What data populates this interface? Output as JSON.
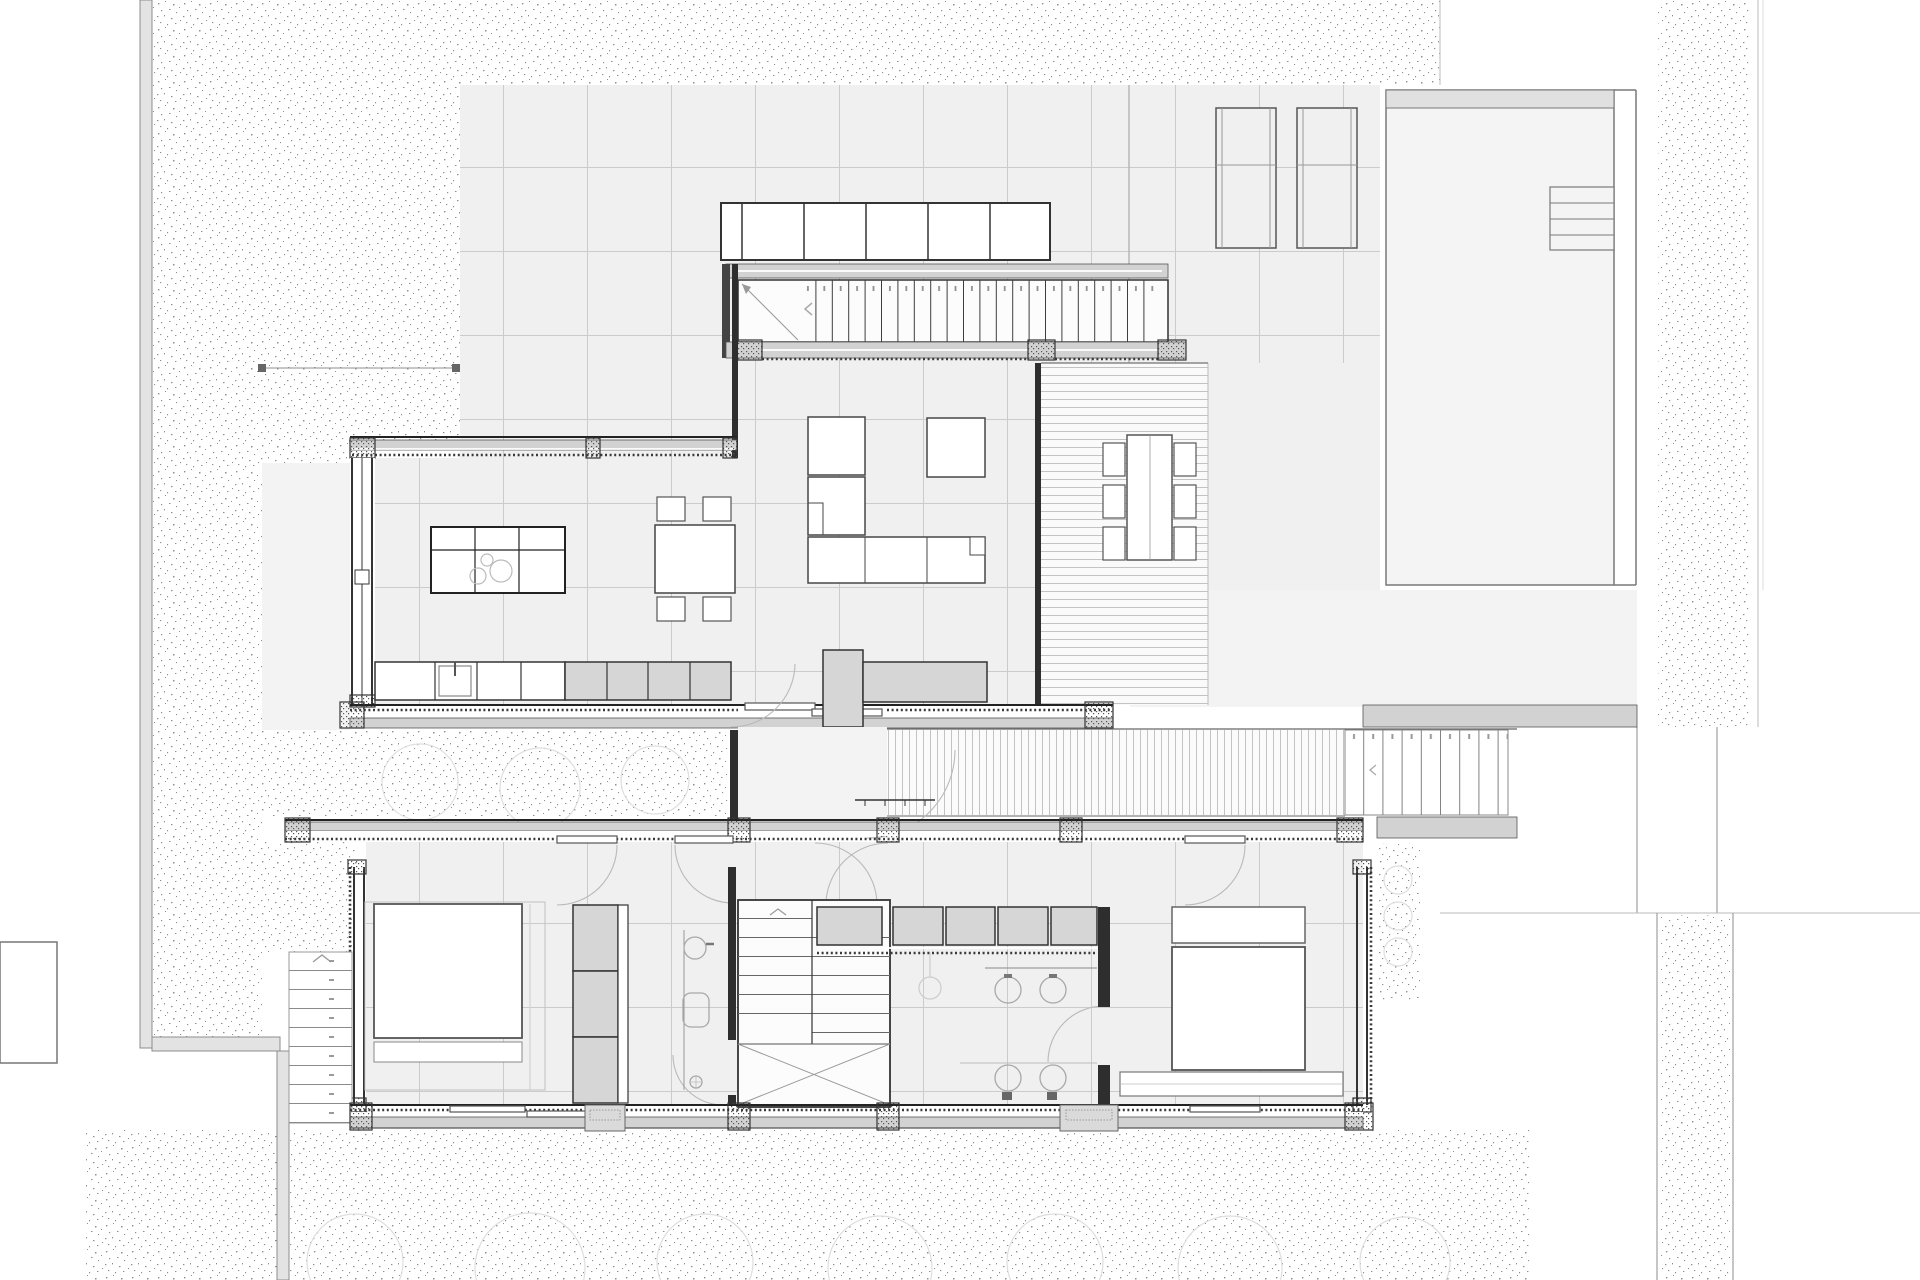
{
  "document": {
    "kind": "architectural floor plan (ground floor, CAD line drawing)",
    "visible_text": "none legible — only tiny tread numerals and direction chevrons on stairs",
    "annotations": {
      "stair_numeral_marks": "small illegible riser numbers above each stair tread",
      "direction_arrows": [
        "<",
        "^"
      ],
      "level_marker": "short ticked threshold line on south walkway"
    }
  },
  "palette": {
    "paper": "#ffffff",
    "floor": "#f0f0f0",
    "floor_light": "#f3f3f3",
    "wall_dark": "#2e2e2e",
    "sill_gray": "#d2d2d2",
    "cabinet_gray": "#d6d6d6",
    "grid_line": "#cbcbcb",
    "stipple_dot": "#8f8f8f",
    "door_arc": "#b9b9b9",
    "fixture_line": "#a8a8a8",
    "pool_fill": "#f4f4f4",
    "boundary_gray": "#e3e3e3",
    "deck_slat": "#c3c3c3",
    "shrub_line": "#dedede"
  },
  "plan_inventory": {
    "site": {
      "gravel_garden_regions": 11,
      "boundary_walls": [
        "west wall",
        "southwest corner return",
        "south spur"
      ],
      "detached_outbuilding": "small white rectangle at far west edge",
      "shrub_circle_outlines": 10
    },
    "terrace": {
      "paving": "square tile grid",
      "built_in_benches": 2,
      "outdoor_dining": {
        "table": 1,
        "chairs": 6
      },
      "pool": {
        "coping_band": "north edge",
        "corner_steps": 4
      }
    },
    "upper_wing": {
      "storage_row_cells": 6,
      "entry_stair": {
        "treads": 22,
        "landing_diagonal": true,
        "numerals": "illegible"
      },
      "living_room": {
        "sofa_modules": 4,
        "dining_table_chairs": 4
      },
      "kitchen": {
        "island_cooktop_rings": 3,
        "sink": 1,
        "base_cabinets_gray": 4,
        "counter_cells_white": 4
      },
      "covered_deck": "horizontal board hatch"
    },
    "link": {
      "corridor": 1,
      "slatted_walkway": "vertical board hatch",
      "east_garden_steps_treads": 8,
      "door_swing_arcs": 8
    },
    "lower_wing": {
      "bedroom_west": {
        "bed": 1,
        "foot_bench": 1,
        "wardrobe_cells": 3
      },
      "bathroom_west": {
        "basin": 1,
        "wc": 1,
        "shower_point": 1
      },
      "internal_stair": {
        "flights": 2,
        "winder_cross": true
      },
      "hall_cabinets": 5,
      "bathroom_central": {
        "basins": 2,
        "wall_hung_wc": 2,
        "pendant_lamp": 1
      },
      "master_bedroom": {
        "bed": 1,
        "headboard": 1,
        "foot_cabinet": 1
      },
      "west_exterior_stair_treads": 9,
      "entry_stoops": 2
    }
  }
}
